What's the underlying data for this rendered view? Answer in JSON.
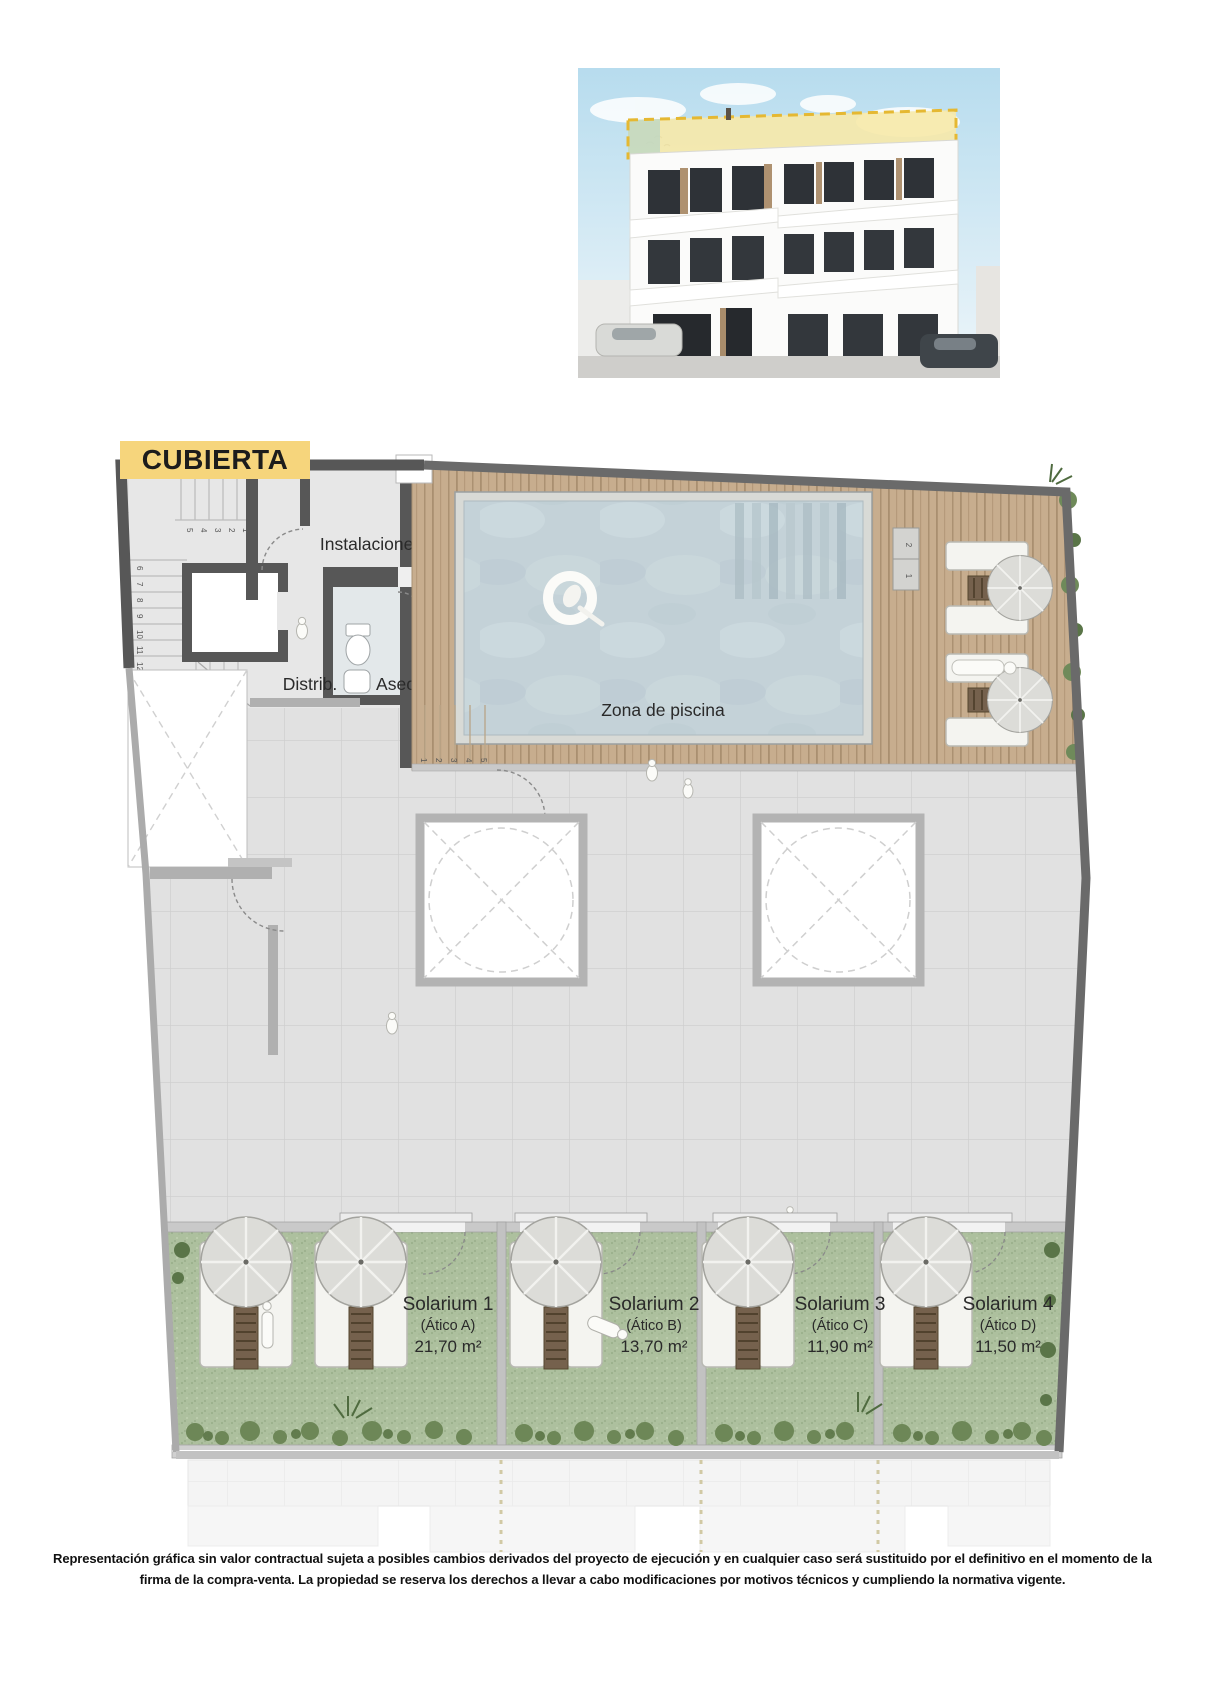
{
  "title": {
    "label": "CUBIERTA"
  },
  "plan": {
    "rooms": {
      "instalaciones": "Instalaciones",
      "distrib": "Distrib.",
      "aseo": "Aseo",
      "pool_zone": "Zona de piscina"
    },
    "solariums": [
      {
        "name": "Solarium 1",
        "unit": "(Ático A)",
        "area": "21,70 m²"
      },
      {
        "name": "Solarium 2",
        "unit": "(Ático B)",
        "area": "13,70 m²"
      },
      {
        "name": "Solarium 3",
        "unit": "(Ático C)",
        "area": "11,90 m²"
      },
      {
        "name": "Solarium 4",
        "unit": "(Ático D)",
        "area": "11,50 m²"
      }
    ],
    "stair_numbers_upper": [
      "1",
      "2",
      "3",
      "4",
      "5"
    ],
    "stair_numbers_lower": [
      "6",
      "7",
      "8",
      "9",
      "10",
      "11",
      "12"
    ],
    "deck_stair_numbers": [
      "1",
      "2",
      "3",
      "4",
      "5"
    ],
    "pool_step_numbers": [
      "1",
      "2"
    ]
  },
  "footer": {
    "line1": "Representación gráfica sin valor contractual sujeta a posibles cambios derivados del proyecto de ejecución y en cualquier caso será sustituido por el definitivo en el momento de la",
    "line2": "firma de la compra-venta. La propiedad se reserva los derechos a llevar a cabo modificaciones por motivos técnicos y cumpliendo la normativa vigente."
  },
  "colors": {
    "accent_yellow": "#F6D57C",
    "wall_dark": "#575757",
    "wood": "#C7AD8E",
    "water": "#C4D2D8",
    "solarium_green": "#ADC09E"
  }
}
